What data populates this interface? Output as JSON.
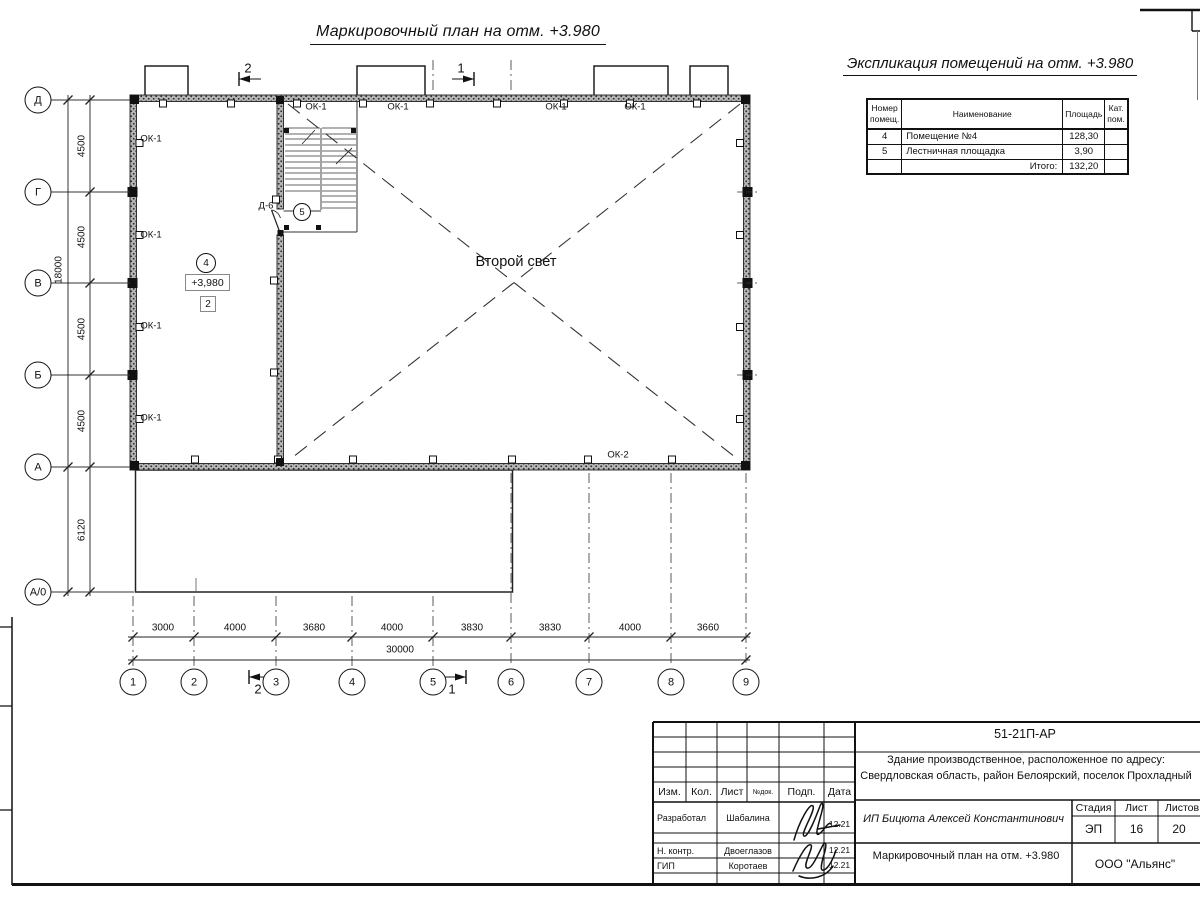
{
  "drawing_title": "Маркировочный план на отм. +3.980",
  "expl": {
    "title": "Экспликация помещений на отм. +3.980",
    "headers": {
      "num": "Номер\nпомещ.",
      "name": "Наименование",
      "area": "Площадь",
      "cat": "Кат.\nпом."
    },
    "rows": [
      {
        "num": "4",
        "name": "Помещение №4",
        "area": "128,30",
        "cat": ""
      },
      {
        "num": "5",
        "name": "Лестничная площадка",
        "area": "3,90",
        "cat": ""
      }
    ],
    "total_label": "Итого:",
    "total_value": "132,20"
  },
  "axes": {
    "rows": [
      {
        "label": "Д",
        "y": 100
      },
      {
        "label": "Г",
        "y": 192
      },
      {
        "label": "В",
        "y": 283
      },
      {
        "label": "Б",
        "y": 375
      },
      {
        "label": "А",
        "y": 467
      },
      {
        "label": "А/0",
        "y": 592
      }
    ],
    "cols": [
      {
        "label": "1",
        "x": 133
      },
      {
        "label": "2",
        "x": 194
      },
      {
        "label": "3",
        "x": 276
      },
      {
        "label": "4",
        "x": 352
      },
      {
        "label": "5",
        "x": 433
      },
      {
        "label": "6",
        "x": 511
      },
      {
        "label": "7",
        "x": 589
      },
      {
        "label": "8",
        "x": 671
      },
      {
        "label": "9",
        "x": 746
      }
    ]
  },
  "dims": {
    "left": [
      {
        "label": "4500",
        "x": 82,
        "y": 146
      },
      {
        "label": "4500",
        "x": 82,
        "y": 237
      },
      {
        "label": "4500",
        "x": 82,
        "y": 329
      },
      {
        "label": "4500",
        "x": 82,
        "y": 421
      },
      {
        "label": "18000",
        "x": 59,
        "y": 270
      },
      {
        "label": "6120",
        "x": 82,
        "y": 530
      }
    ],
    "bottom": [
      {
        "label": "3000",
        "x": 163,
        "y": 628
      },
      {
        "label": "4000",
        "x": 235,
        "y": 628
      },
      {
        "label": "3680",
        "x": 314,
        "y": 628
      },
      {
        "label": "4000",
        "x": 392,
        "y": 628
      },
      {
        "label": "3830",
        "x": 472,
        "y": 628
      },
      {
        "label": "3830",
        "x": 550,
        "y": 628
      },
      {
        "label": "4000",
        "x": 630,
        "y": 628
      },
      {
        "label": "3660",
        "x": 708,
        "y": 628
      },
      {
        "label": "30000",
        "x": 400,
        "y": 650
      }
    ]
  },
  "window_labels": [
    {
      "label": "ОК-1",
      "x": 151,
      "y": 139
    },
    {
      "label": "ОК-1",
      "x": 151,
      "y": 235
    },
    {
      "label": "ОК-1",
      "x": 151,
      "y": 326
    },
    {
      "label": "ОК-1",
      "x": 151,
      "y": 418
    },
    {
      "label": "ОК-1",
      "x": 316,
      "y": 107
    },
    {
      "label": "ОК-1",
      "x": 398,
      "y": 107
    },
    {
      "label": "ОК-1",
      "x": 556,
      "y": 107
    },
    {
      "label": "ОК-1",
      "x": 635,
      "y": 107
    },
    {
      "label": "ОК-2",
      "x": 618,
      "y": 455
    }
  ],
  "section_marks": [
    {
      "label": "2",
      "x": 248,
      "y": 68
    },
    {
      "label": "1",
      "x": 461,
      "y": 68
    },
    {
      "label": "2",
      "x": 258,
      "y": 689
    },
    {
      "label": "1",
      "x": 452,
      "y": 689
    }
  ],
  "markers": {
    "room4_num": "4",
    "room4_elev": "+3,980",
    "room4_type": "2",
    "room5_num": "5",
    "door": "Д-6",
    "void": "Второй свет"
  },
  "titleblock": {
    "doc_code": "51-21П-АР",
    "address": "Здание производственное, расположенное по адресу: Свердловская область, район Белоярский, поселок Прохладный",
    "client": "ИП Бицюта Алексей Константинович",
    "sheet_title": "Маркировочный план на отм. +3.980",
    "org": "ООО \"Альянс\"",
    "stage_label": "Стадия",
    "sheet_label": "Лист",
    "sheets_label": "Листов",
    "stage": "ЭП",
    "sheet": "16",
    "sheets": "20",
    "cols": {
      "izm": "Изм.",
      "kol": "Кол.",
      "list": "Лист",
      "ndoc": "№док.",
      "podp": "Подп.",
      "data": "Дата"
    },
    "roles": [
      {
        "role": "Разработал",
        "name": "Шабалина",
        "date": "12.21"
      },
      {
        "role": "Н. контр.",
        "name": "Двоеглазов",
        "date": "12.21"
      },
      {
        "role": "ГИП",
        "name": "Коротаев",
        "date": "12.21"
      }
    ]
  }
}
